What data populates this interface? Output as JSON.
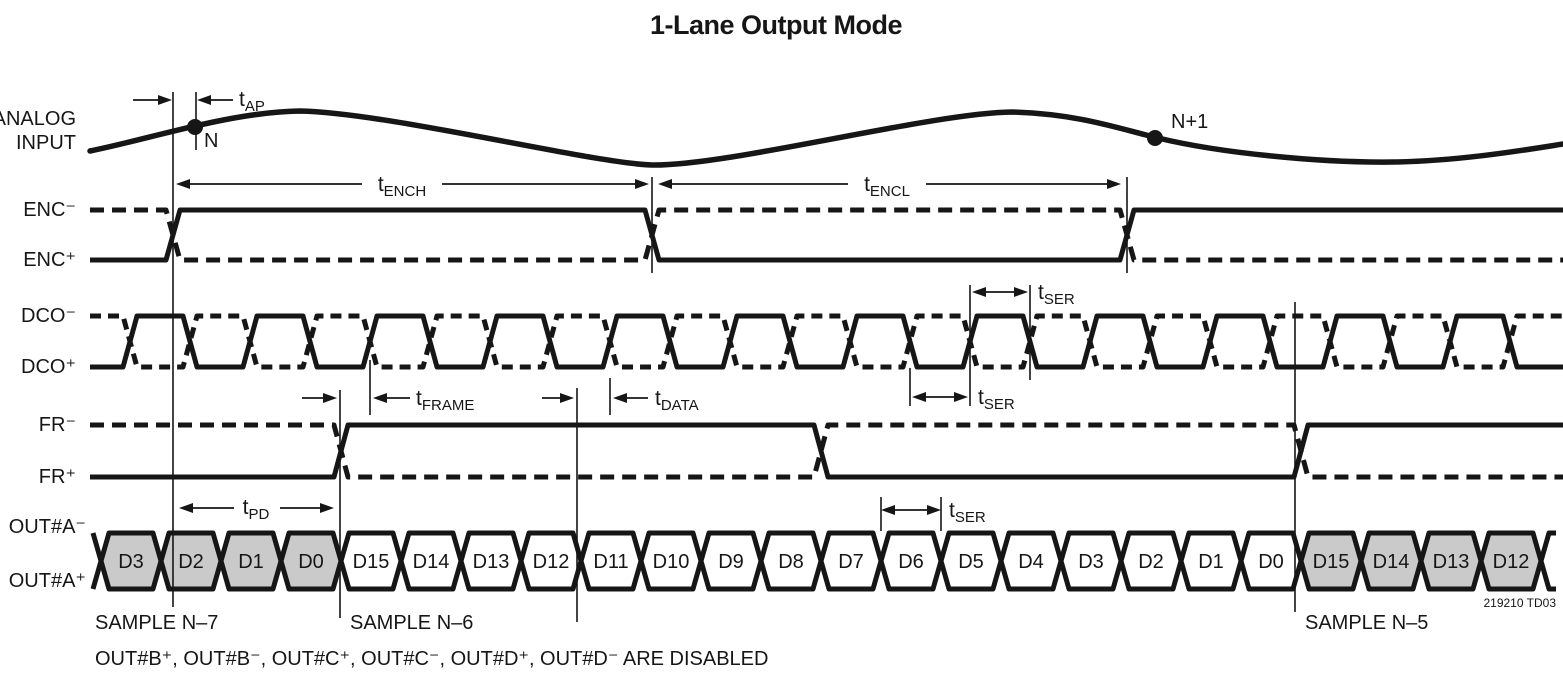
{
  "title": "1-Lane Output Mode",
  "signals": {
    "analog_line1": "ANALOG",
    "analog_line2": "INPUT",
    "enc_neg": "ENC⁻",
    "enc_pos": "ENC⁺",
    "dco_neg": "DCO⁻",
    "dco_pos": "DCO⁺",
    "fr_neg": "FR⁻",
    "fr_pos": "FR⁺",
    "outa_neg": "OUT#A⁻",
    "outa_pos": "OUT#A⁺"
  },
  "timing_labels": {
    "tap": {
      "base": "t",
      "sub": "AP"
    },
    "tench": {
      "base": "t",
      "sub": "ENCH"
    },
    "tencl": {
      "base": "t",
      "sub": "ENCL"
    },
    "tser": {
      "base": "t",
      "sub": "SER"
    },
    "tframe": {
      "base": "t",
      "sub": "FRAME"
    },
    "tdata": {
      "base": "t",
      "sub": "DATA"
    },
    "tpd": {
      "base": "t",
      "sub": "PD"
    }
  },
  "markers": {
    "sample_n": "N",
    "sample_n_plus_1": "N+1"
  },
  "samples": {
    "n7": "SAMPLE N–7",
    "n6": "SAMPLE N–6",
    "n5": "SAMPLE N–5"
  },
  "out_lane": {
    "cells": [
      {
        "label": "D3",
        "shaded": true
      },
      {
        "label": "D2",
        "shaded": true
      },
      {
        "label": "D1",
        "shaded": true
      },
      {
        "label": "D0",
        "shaded": true
      },
      {
        "label": "D15",
        "shaded": false
      },
      {
        "label": "D14",
        "shaded": false
      },
      {
        "label": "D13",
        "shaded": false
      },
      {
        "label": "D12",
        "shaded": false
      },
      {
        "label": "D11",
        "shaded": false
      },
      {
        "label": "D10",
        "shaded": false
      },
      {
        "label": "D9",
        "shaded": false
      },
      {
        "label": "D8",
        "shaded": false
      },
      {
        "label": "D7",
        "shaded": false
      },
      {
        "label": "D6",
        "shaded": false
      },
      {
        "label": "D5",
        "shaded": false
      },
      {
        "label": "D4",
        "shaded": false
      },
      {
        "label": "D3",
        "shaded": false
      },
      {
        "label": "D2",
        "shaded": false
      },
      {
        "label": "D1",
        "shaded": false
      },
      {
        "label": "D0",
        "shaded": false
      },
      {
        "label": "D15",
        "shaded": true
      },
      {
        "label": "D14",
        "shaded": true
      },
      {
        "label": "D13",
        "shaded": true
      },
      {
        "label": "D12",
        "shaded": true
      }
    ]
  },
  "footnote": "OUT#B⁺, OUT#B⁻, OUT#C⁺, OUT#C⁻, OUT#D⁺, OUT#D⁻ ARE DISABLED",
  "doc_code": "219210 TD03",
  "colors": {
    "ink": "#161616",
    "cell_shade": "#cacaca",
    "cell_white": "#ffffff",
    "background": "#ffffff"
  }
}
